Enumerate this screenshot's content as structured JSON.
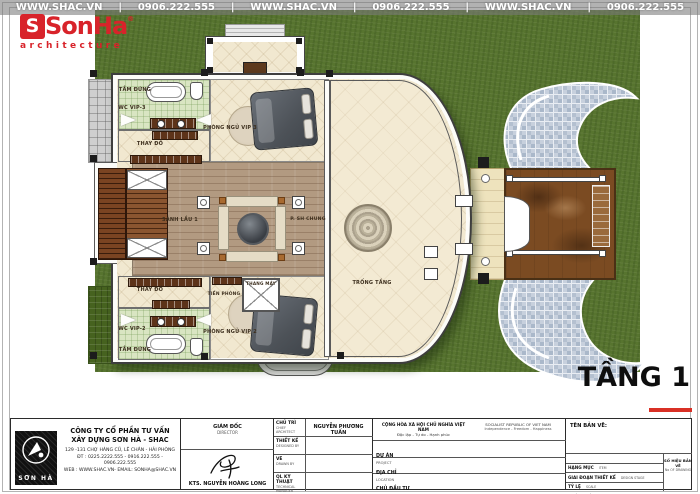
{
  "brand": {
    "name": "SonHa",
    "initial": "S",
    "reg": "®",
    "tagline": "architecture"
  },
  "watermark": {
    "site": "WWW.SHAC.VN",
    "phone": "0906.222.555",
    "sep": "|"
  },
  "floor": {
    "label": "TẦNG 1"
  },
  "rooms": {
    "bedroom_vip3": "PHÒNG NGỦ VIP 3",
    "bedroom_vip2": "PHÒNG NGỦ VIP 2",
    "wc_vip3": "WC VIP-3",
    "wc_vip2": "WC VIP-2",
    "shower": "TẮM ĐỨNG",
    "dressing": "THAY ĐỒ",
    "hall": "SẢNH LẦU 1",
    "common_room": "P. SH CHUNG",
    "void": "TRỐNG TẦNG",
    "vestibule": "TIỀN PHÒNG",
    "elevator": "THANG MÁY"
  },
  "title_block": {
    "company": {
      "logo_text": "SƠN HÀ",
      "name_line1": "CÔNG TY CỔ PHẦN TƯ VẤN",
      "name_line2": "XÂY DỰNG SƠN HÀ - SHAC",
      "address": "129 -131 CHỢ HÀNG CŨ, LÊ CHÂN - HẢI PHÒNG",
      "phone": "ĐT : 0225.2222.555 - 0916.222.555 - 0906.222.555",
      "web": "WEB : WWW.SHAC.VN- EMAIL: SONHA@SHAC.VN"
    },
    "director": {
      "title_vi": "GIÁM ĐỐC",
      "title_en": "DIRECTOR",
      "name": "KTS. NGUYỄN HOÀNG LONG"
    },
    "roles": [
      {
        "vi": "CHỦ TRÌ",
        "en": "CHIEF ARCHITECT",
        "value": "NGUYỄN PHƯƠNG TUẤN"
      },
      {
        "vi": "THIẾT KẾ",
        "en": "DESIGNED BY",
        "value": ""
      },
      {
        "vi": "VẼ",
        "en": "DRAWN BY",
        "value": ""
      },
      {
        "vi": "QL KỸ THUẬT",
        "en": "TECHNICAL MANAGER",
        "value": ""
      }
    ],
    "national": {
      "vi1": "CỘNG HÒA XÃ HỘI CHỦ NGHĨA VIỆT NAM",
      "vi2": "Độc lập - Tự do - Hạnh phúc",
      "en1": "SOCIALIST REPUBLIC OF VIET NAM",
      "en2": "Independence - Freedom - Happiness"
    },
    "project_rows": [
      {
        "vi": "DỰ ÁN",
        "en": "PROJECT"
      },
      {
        "vi": "ĐỊA CHỈ",
        "en": "LOCATION"
      },
      {
        "vi": "CHỦ ĐẦU TƯ",
        "en": "INVESTOR"
      }
    ],
    "drawing": {
      "title_label": "TÊN BẢN VẼ:",
      "rows": [
        {
          "vi": "HẠNG MỤC",
          "en": "ITEM"
        },
        {
          "vi": "GIAI ĐOẠN THIẾT KẾ",
          "en": "DESIGN STAGE"
        },
        {
          "vi": "TỶ LỆ",
          "en": "SCALE"
        },
        {
          "vi": "NGÀY THÁNG",
          "en": "DATE"
        }
      ],
      "number_vi": "SỐ HIỆU BẢN VẼ",
      "number_en": "No OF DRAWING"
    }
  },
  "colors": {
    "accent_red": "#d8232a",
    "grass_green": "#57742f",
    "mosaic_blue": "#b7c3d3",
    "porch_brown": "#7b4b22"
  }
}
